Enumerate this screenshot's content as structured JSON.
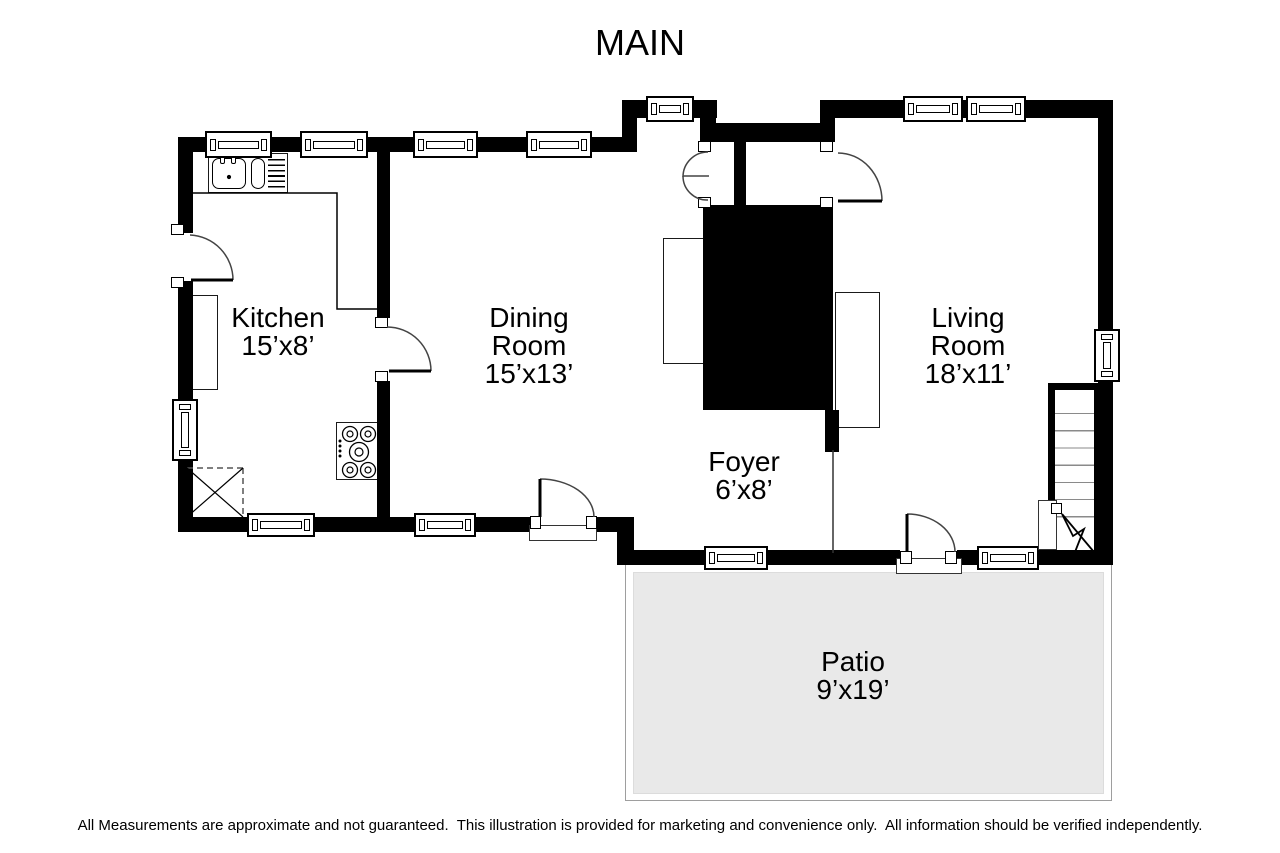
{
  "title": "MAIN",
  "rooms": {
    "kitchen": {
      "lines": [
        "Kitchen",
        "15’x8’"
      ]
    },
    "dining": {
      "lines": [
        "Dining",
        "Room",
        "15’x13’"
      ]
    },
    "foyer": {
      "lines": [
        "Foyer",
        "6’x8’"
      ]
    },
    "living": {
      "lines": [
        "Living",
        "Room",
        "18’x11’"
      ]
    },
    "patio": {
      "lines": [
        "Patio",
        "9’x19’"
      ]
    }
  },
  "disclaimer": "All Measurements are approximate and not guaranteed.  This illustration is provided for marketing and convenience only.  All information should be verified independently.",
  "colors": {
    "wall": "#000000",
    "patio_fill": "#e9e9e9",
    "patio_border": "#9e9e9e"
  }
}
